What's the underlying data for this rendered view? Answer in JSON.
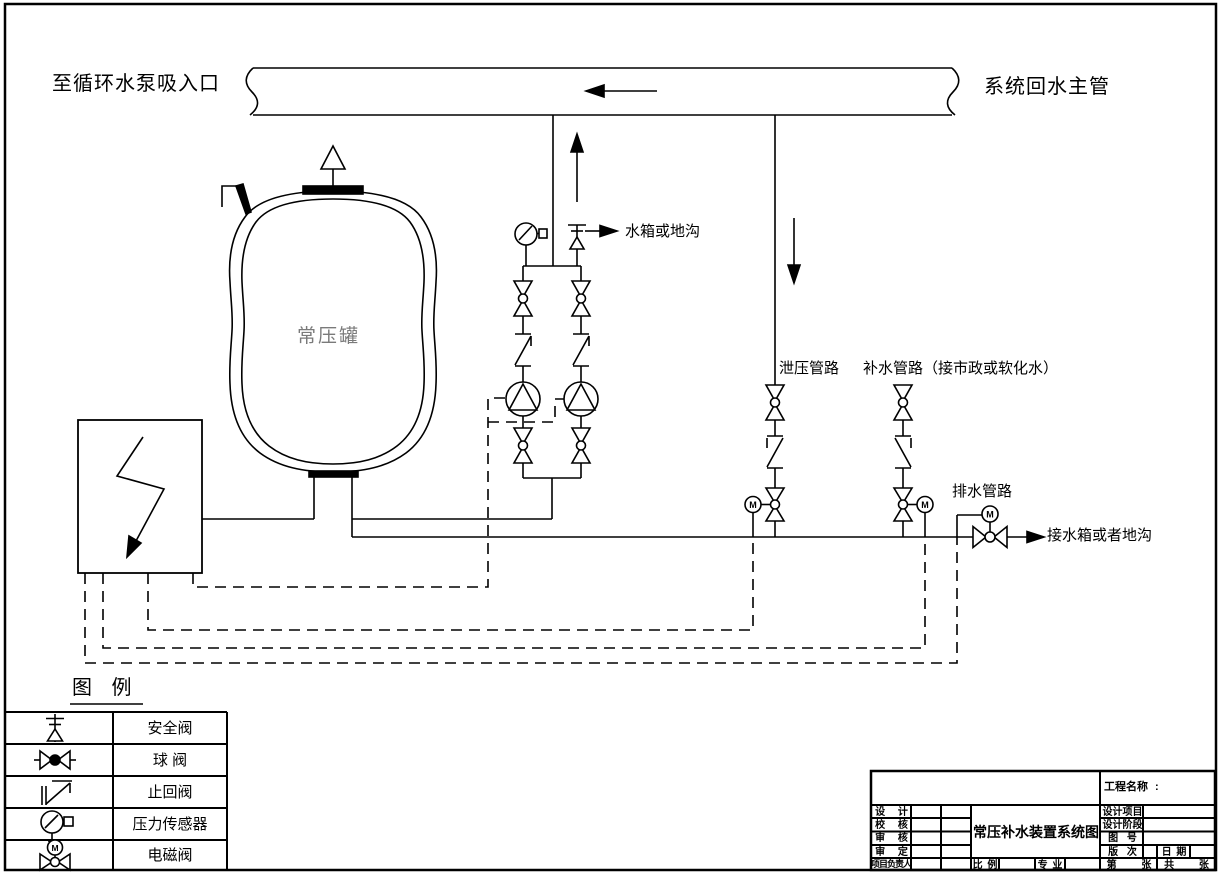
{
  "page": {
    "labels": {
      "to_pump_suction": "至循环水泵吸入口",
      "system_return_main": "系统回水主管",
      "tank": "常压罐",
      "tank_or_trench": "水箱或地沟",
      "relief_line": "泄压管路",
      "makeup_line": "补水管路（接市政或软化水）",
      "drain_line": "排水管路",
      "to_tank_or_trench": "接水箱或者地沟"
    }
  },
  "symbols": {
    "motor_letter": "M"
  },
  "legend": {
    "title": "图 例",
    "items": [
      {
        "symbol": "safety-valve-icon",
        "label": "安全阀"
      },
      {
        "symbol": "ball-valve-icon",
        "label": "球 阀"
      },
      {
        "symbol": "check-valve-icon",
        "label": "止回阀"
      },
      {
        "symbol": "pressure-sensor-icon",
        "label": "压力传感器"
      },
      {
        "symbol": "solenoid-valve-icon",
        "label": "电磁阀"
      }
    ]
  },
  "title_block": {
    "project_name": "工程名称 :",
    "designer": "设 计",
    "checker": "校 核",
    "reviewer": "审 核",
    "approver": "审 定",
    "project_manager": "项目负责人",
    "drawing_title": "常压补水装置系统图",
    "scale": "比 例",
    "specialty": "专 业",
    "design_project": "设计项目",
    "design_stage": "设计阶段",
    "drawing_number": "图 号",
    "revision": "版 次",
    "date": "日 期",
    "sheet": "第 张",
    "total_sheets": "共 张"
  },
  "colors": {
    "line": "#000000",
    "background": "#ffffff",
    "tank_label": "#7a7a7a"
  }
}
